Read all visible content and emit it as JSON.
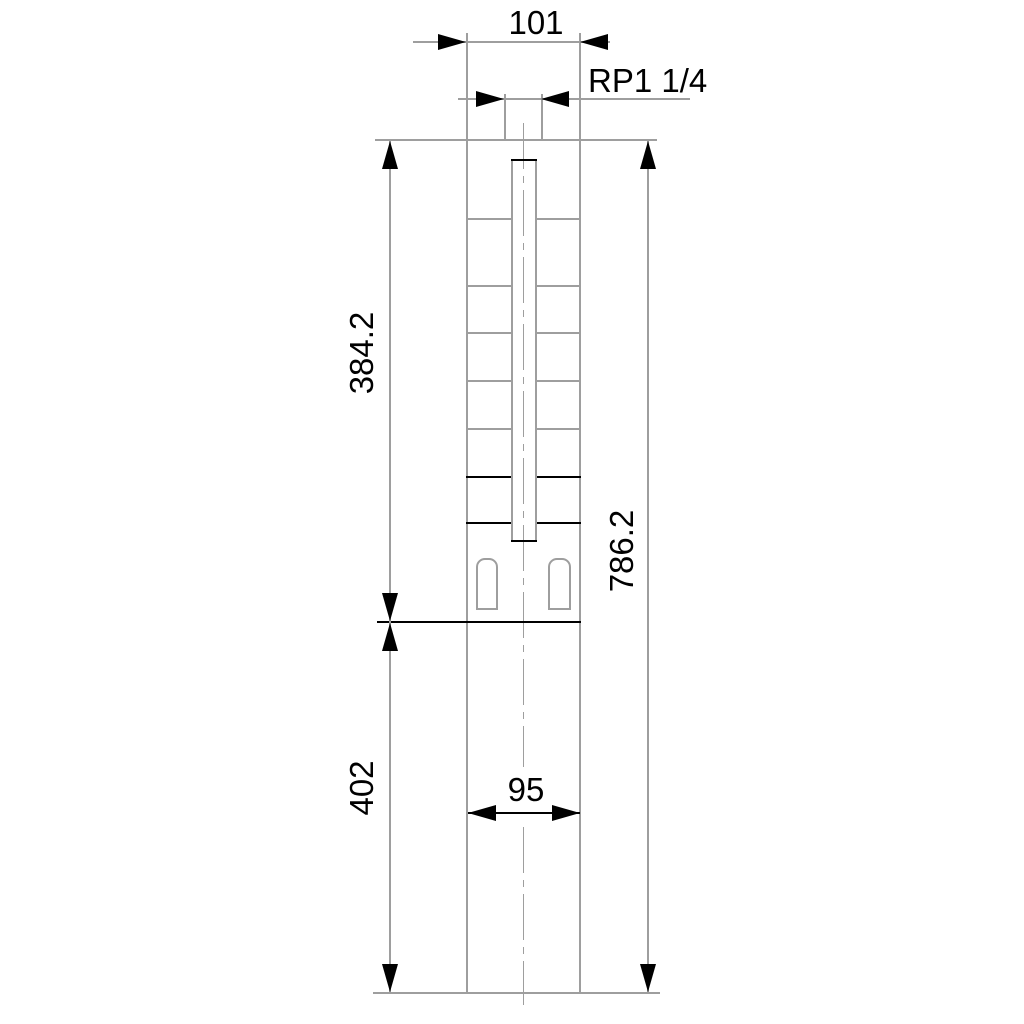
{
  "drawing": {
    "title": "pump outline dimension drawing",
    "colors": {
      "background": "#ffffff",
      "outline_gray": "#9e9e9e",
      "accent_black": "#000000",
      "text": "#000000"
    },
    "labels": {
      "width_top": "101",
      "thread": "RP1 1/4",
      "upper_length": "384.2",
      "lower_length": "402",
      "total_length": "786.2",
      "motor_width": "95"
    },
    "dimensions": [
      {
        "label": "101",
        "orientation": "horizontal"
      },
      {
        "label": "RP1 1/4",
        "orientation": "horizontal"
      },
      {
        "label": "384.2",
        "orientation": "vertical"
      },
      {
        "label": "402",
        "orientation": "vertical"
      },
      {
        "label": "786.2",
        "orientation": "vertical"
      },
      {
        "label": "95",
        "orientation": "horizontal"
      }
    ]
  }
}
